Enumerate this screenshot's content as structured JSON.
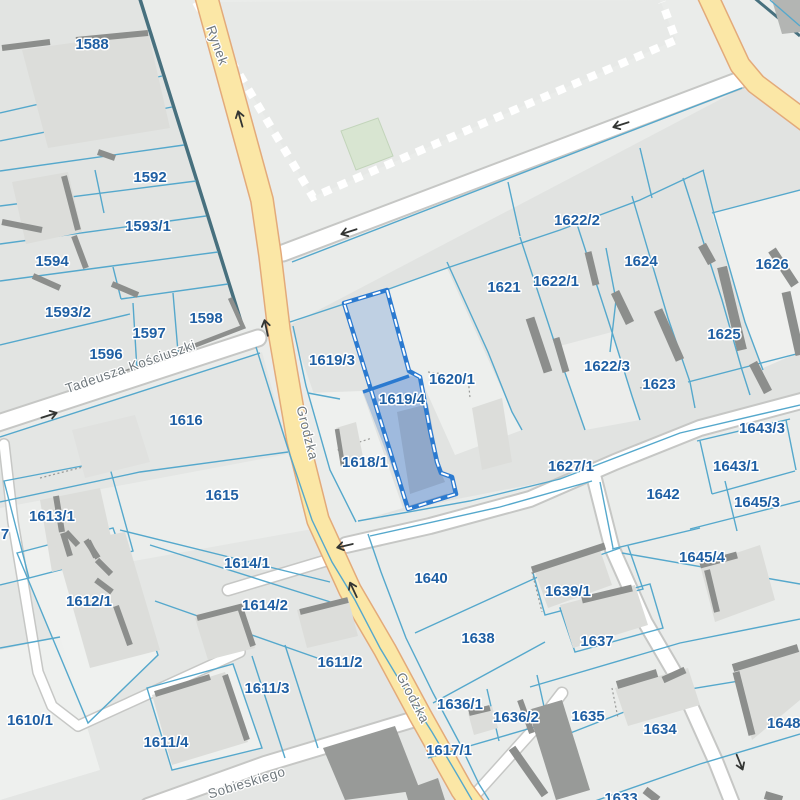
{
  "map": {
    "selected_parcel": "1619/4",
    "colors": {
      "background": "#eaecea",
      "block_fill": "#e2e4e2",
      "light_parcel": "#eff1ef",
      "parcel_line_blue": "#55a8cc",
      "block_edge_teal": "#47707e",
      "road_yellow": "#fbe7a6",
      "road_yellow_casing": "#e3aa7a",
      "road_white": "#ffffff",
      "road_white_casing": "#c6c7c5",
      "building_fill": "#dcddda",
      "building_wall": "#8c8e8c",
      "selection_border": "#2b7ad0",
      "selection_fill": "#b9cfe9",
      "parcel_label_color": "#1f5fa3",
      "street_label_color": "#6f787d",
      "market_dash": "#ffffff",
      "green_area": "#d8e5d1"
    },
    "icons": {
      "one_way_arrow": "small dark arrow on carriageway"
    },
    "parcel_labels": [
      {
        "text": "1588",
        "x": 92,
        "y": 49
      },
      {
        "text": "1592",
        "x": 150,
        "y": 182
      },
      {
        "text": "1593/1",
        "x": 148,
        "y": 231
      },
      {
        "text": "1594",
        "x": 52,
        "y": 266
      },
      {
        "text": "1593/2",
        "x": 68,
        "y": 317
      },
      {
        "text": "1598",
        "x": 206,
        "y": 323
      },
      {
        "text": "1597",
        "x": 149,
        "y": 338
      },
      {
        "text": "1596",
        "x": 106,
        "y": 359
      },
      {
        "text": "1616",
        "x": 186,
        "y": 425
      },
      {
        "text": "1615",
        "x": 222,
        "y": 500
      },
      {
        "text": "1613/1",
        "x": 52,
        "y": 521
      },
      {
        "text": "7",
        "x": 5,
        "y": 539
      },
      {
        "text": "1612/1",
        "x": 89,
        "y": 606
      },
      {
        "text": "1610/1",
        "x": 30,
        "y": 725
      },
      {
        "text": "1614/1",
        "x": 247,
        "y": 568
      },
      {
        "text": "1614/2",
        "x": 265,
        "y": 610
      },
      {
        "text": "1611/2",
        "x": 340,
        "y": 667
      },
      {
        "text": "1611/3",
        "x": 267,
        "y": 693
      },
      {
        "text": "1611/4",
        "x": 166,
        "y": 747
      },
      {
        "text": "1619/3",
        "x": 332,
        "y": 365
      },
      {
        "text": "1619/4",
        "x": 402,
        "y": 404
      },
      {
        "text": "1618/1",
        "x": 365,
        "y": 467
      },
      {
        "text": "1620/1",
        "x": 452,
        "y": 384
      },
      {
        "text": "1621",
        "x": 504,
        "y": 292
      },
      {
        "text": "1622/1",
        "x": 556,
        "y": 286
      },
      {
        "text": "1622/2",
        "x": 577,
        "y": 225
      },
      {
        "text": "1624",
        "x": 641,
        "y": 266
      },
      {
        "text": "1626",
        "x": 772,
        "y": 269
      },
      {
        "text": "1625",
        "x": 724,
        "y": 339
      },
      {
        "text": "1622/3",
        "x": 607,
        "y": 371
      },
      {
        "text": "1623",
        "x": 659,
        "y": 389
      },
      {
        "text": "1627/1",
        "x": 571,
        "y": 471
      },
      {
        "text": "1642",
        "x": 663,
        "y": 499
      },
      {
        "text": "1643/3",
        "x": 762,
        "y": 433
      },
      {
        "text": "1643/1",
        "x": 736,
        "y": 471
      },
      {
        "text": "1645/3",
        "x": 757,
        "y": 507
      },
      {
        "text": "1645/4",
        "x": 702,
        "y": 562
      },
      {
        "text": "1640",
        "x": 431,
        "y": 583
      },
      {
        "text": "1639/1",
        "x": 568,
        "y": 596
      },
      {
        "text": "1638",
        "x": 478,
        "y": 643
      },
      {
        "text": "1637",
        "x": 597,
        "y": 646
      },
      {
        "text": "1636/1",
        "x": 460,
        "y": 709
      },
      {
        "text": "1636/2",
        "x": 516,
        "y": 722
      },
      {
        "text": "1635",
        "x": 588,
        "y": 721
      },
      {
        "text": "1634",
        "x": 660,
        "y": 734
      },
      {
        "text": "1648/1",
        "x": 790,
        "y": 728
      },
      {
        "text": "1617/1",
        "x": 449,
        "y": 755
      },
      {
        "text": "1633",
        "x": 621,
        "y": 803
      }
    ],
    "street_labels": [
      {
        "text": "Rynek",
        "x": 213,
        "y": 47,
        "rot": 70
      },
      {
        "text": "Tadeusza Kościuszki",
        "x": 132,
        "y": 371,
        "rot": -19
      },
      {
        "text": "Grodzka",
        "x": 303,
        "y": 434,
        "rot": 76
      },
      {
        "text": "Grodzka",
        "x": 409,
        "y": 700,
        "rot": 62
      },
      {
        "text": "Sobieskiego",
        "x": 248,
        "y": 787,
        "rot": -17
      }
    ],
    "arrows": [
      {
        "x": 240,
        "y": 118,
        "rot": 254
      },
      {
        "x": 266,
        "y": 327,
        "rot": 258
      },
      {
        "x": 348,
        "y": 232,
        "rot": 162
      },
      {
        "x": 620,
        "y": 125,
        "rot": 162
      },
      {
        "x": 50,
        "y": 415,
        "rot": -18
      },
      {
        "x": 353,
        "y": 589,
        "rot": 245
      },
      {
        "x": 344,
        "y": 546,
        "rot": 167
      },
      {
        "x": 740,
        "y": 763,
        "rot": 68
      }
    ]
  }
}
